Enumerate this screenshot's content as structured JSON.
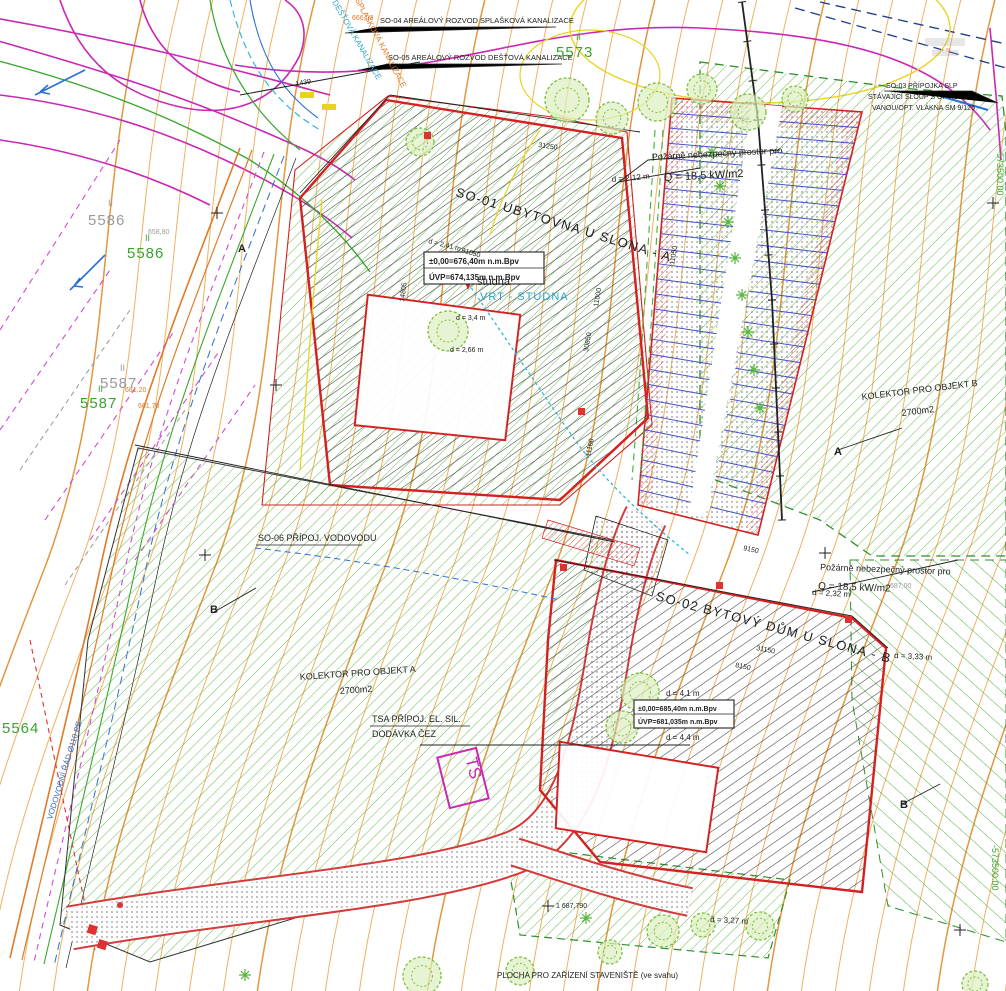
{
  "labels": {
    "so04": "SO-04 AREÁLOVÝ ROZVOD SPLAŠKOVÁ KANALIZACE",
    "so05": "SO-05 AREÁLOVÝ ROZVOD DEŠŤOVÁ KANALIZACE",
    "so03_1": "SO-03 PŘÍPOJKA SLP",
    "so03_2": "STÁVAJÍCÍ SLOUP S OPTICKOU",
    "so03_3": "VANOU/OPT. VLÁKNA SM 9/125",
    "so01": "SO-01 UBYTOVNA U SLONA - A",
    "so02": "SO-02 BYTOVÝ DŮM U SLONA - B",
    "so06": "SO-06 PŘÍPOJ. VODOVODU",
    "tsa_1": "TSA PŘÍPOJ. EL. SIL.",
    "tsa_2": "DODÁVKA ČEZ",
    "kolektor_a_1": "KOLEKTOR  PRO OBJEKT A",
    "kolektor_a_2": "2700m2",
    "kolektor_b_1": "KOLEKTOR  PRO OBJEKT B",
    "kolektor_b_2": "2700m2",
    "fire_top_1": "Požárně nebezpečný prostor pro",
    "fire_top_2": "Q = 18,5 kW/m2",
    "fire_right_1": "Požárně nebezpečný prostor pro",
    "fire_right_2": "Q = 18,5 kW/m2",
    "site_area": "PLOCHA PRO ZAŘÍZENÍ STAVENIŠTĚ (ve svahu)",
    "studna": "studna",
    "vrt_studna": "VRT - STUDNA",
    "ts": "TS"
  },
  "elevation_boxes": {
    "box_a_1": "±0,00=676,40m n.m.Bpv",
    "box_a_2": "ÚVP=674,135m n.m.Bpv",
    "box_b_1": "±0,00=685,40m n.m.Bpv",
    "box_b_2": "ÚVP=681,035m n.m.Bpv"
  },
  "dimensions": {
    "d212": "d = 2,12 m",
    "d241": "d = 2,41 m",
    "d266": "d = 2,66 m",
    "d34": "d = 3,4 m",
    "d41": "d = 4,1 m",
    "d44": "d = 4,4 m",
    "d232": "d = 2,32 m",
    "d333": "d = 3,33 m",
    "d327": "d = 3,27 m"
  },
  "measurements": {
    "m31250": "31250",
    "m91050": "91050",
    "m14805": "14805",
    "m11000": "11000",
    "m30850": "30850",
    "m11050": "11050",
    "m11100": "11100",
    "m9150": "9150",
    "m8150": "8150",
    "m31150": "31150",
    "m1439": "1439"
  },
  "parcels": {
    "p5586": "5586",
    "p5587": "5587",
    "p5573": "5573",
    "p5564": "5564",
    "tick": "II"
  },
  "spot_heights": {
    "s666": "666,03",
    "s658": "658,80",
    "s681": "681,20",
    "s661": "661,70",
    "s687": "687,00",
    "s1687": "1 687,790"
  },
  "grid": {
    "y573500": "-573500.00"
  },
  "utilities": {
    "splaskova": "SPLAŠKOVÁ KANALIZACE",
    "destova": "DEŠŤOVÁ KANALIZACE",
    "vodovod": "VODOVODNÍ ŘÁD Ø110 PE"
  },
  "sections": {
    "a": "A",
    "b": "B"
  },
  "colors": {
    "contour": "#ECA94E",
    "green_hatch": "#55B43C",
    "building_outline": "#D42020",
    "parking_stall": "#4553C4",
    "magenta_road": "#C928B5",
    "water_blue": "#2AA7C9"
  }
}
